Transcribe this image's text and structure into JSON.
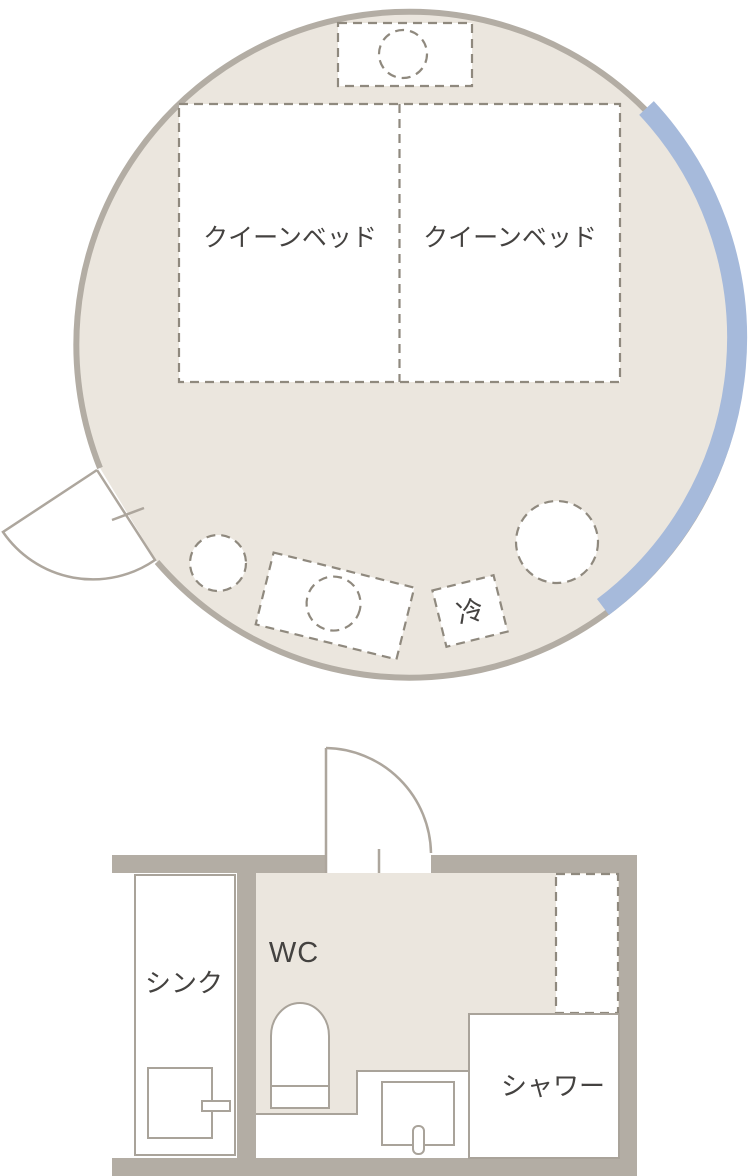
{
  "room": {
    "bed_left_label": "クイーンベッド",
    "bed_right_label": "クイーンベッド",
    "fridge_label": "冷"
  },
  "bathroom": {
    "sink_label": "シンク",
    "wc_label": "WC",
    "shower_label": "シャワー"
  },
  "colors": {
    "floor_beige": "#EBE6DE",
    "wall_gray": "#B3ADA4",
    "outline_gray": "#A9A39A",
    "dash_gray": "#8F897E",
    "window_blue": "#A6BADB",
    "text_dark": "#444240"
  }
}
